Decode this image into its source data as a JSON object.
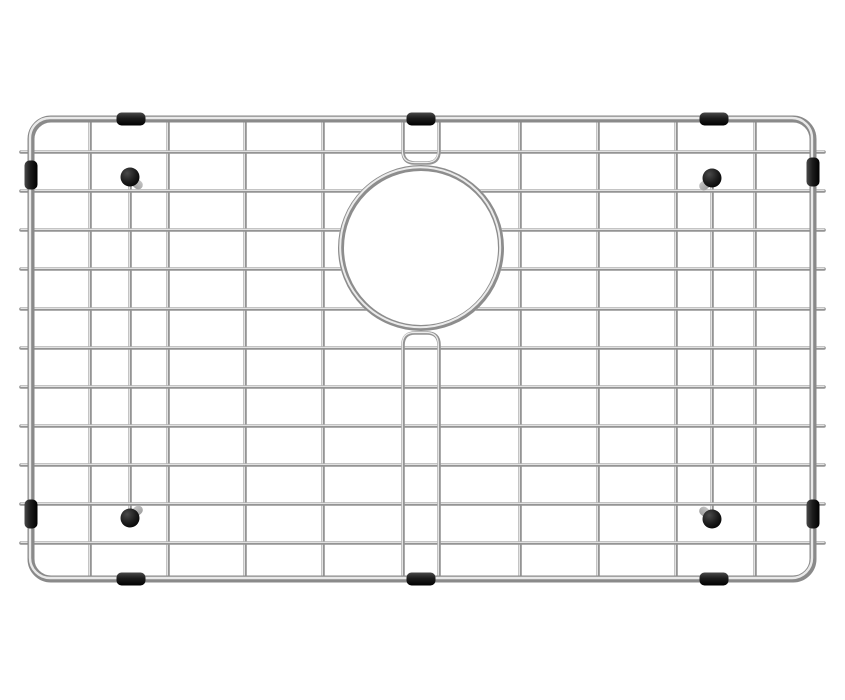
{
  "image": {
    "description": "Stainless steel kitchen sink bottom grid with circular drain opening, black rubber feet and edge bumpers, photographed on a plain white background",
    "background_color": "#ffffff"
  },
  "colors": {
    "steel_wire_base": "#949494",
    "steel_wire_highlight": "#ececec",
    "steel_frame_base": "#8a8a8a",
    "steel_frame_highlight": "#e9e9e9",
    "steel_ring_base": "#8d8d8d",
    "steel_ring_highlight": "#ebebeb",
    "rubber_black": "#1c1c1c",
    "rubber_sheen": "#4a4a4a",
    "foot_stub_gray": "#a0a0a0",
    "foot_stub_shadow": "#c4c4c4"
  },
  "geometry": {
    "canvas": {
      "width": 845,
      "height": 700
    },
    "frame": {
      "left": 31,
      "top": 119,
      "right": 813,
      "bottom": 579,
      "corner_radius": 20,
      "tube_width": 7,
      "highlight_width": 2.4
    },
    "wires": {
      "width": 3.6,
      "highlight_width": 1.2,
      "horizontal_y": [
        152,
        191,
        230,
        269,
        309,
        348,
        387,
        426,
        465,
        504,
        543
      ],
      "horizontal_x_start": 21,
      "horizontal_x_end": 824,
      "vertical_x": [
        90,
        168,
        245,
        323,
        520,
        598,
        676,
        755
      ],
      "foot_wire_x": [
        130,
        712
      ],
      "foot_wire_top_y": 177,
      "foot_wire_bottom_y": 518
    },
    "drain_ring": {
      "cx": 421,
      "cy": 248,
      "outer_radius": 83,
      "tube_width": 6,
      "highlight_width": 2
    },
    "bypass_pair": {
      "x_left": 403,
      "x_right": 439,
      "top_dip_y": 163,
      "bottom_rise_y": 333,
      "corner": 12
    },
    "bumpers": {
      "length": 29,
      "thickness": 13,
      "corner_radius": 5,
      "top_edge_x": [
        131,
        421,
        714
      ],
      "bottom_edge_x": [
        131,
        421,
        714
      ],
      "left_edge_y": [
        175,
        514
      ],
      "right_edge_y": [
        172,
        514
      ]
    },
    "feet": {
      "cap_radius": 9.5,
      "stub_length": 15,
      "stub_thickness": 9,
      "items": [
        {
          "x": 130,
          "y": 177,
          "stub_direction": "down-right"
        },
        {
          "x": 712,
          "y": 178,
          "stub_direction": "down-left"
        },
        {
          "x": 130,
          "y": 518,
          "stub_direction": "up-right"
        },
        {
          "x": 712,
          "y": 519,
          "stub_direction": "up-left"
        }
      ]
    }
  }
}
